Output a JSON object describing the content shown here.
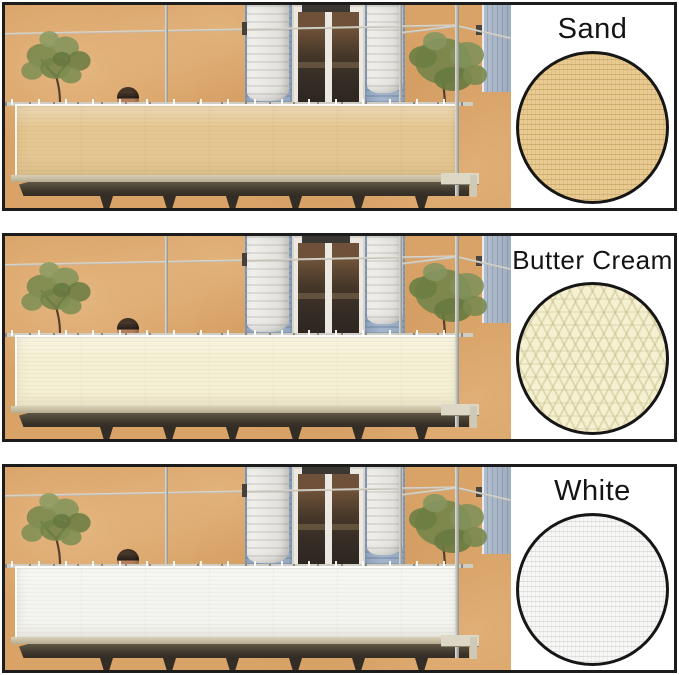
{
  "sheet": {
    "background": "#ffffff",
    "panel_border_color": "#1c1c1c",
    "text_color": "#141414"
  },
  "panels": [
    {
      "label": "Sand",
      "screen_color": "#e4c691",
      "swatch_color": "#e8cb90",
      "swatch_texture": "fine-rows-sand"
    },
    {
      "label": "Butter Cream",
      "screen_color": "#f5efd3",
      "swatch_color": "#f4f0d0",
      "swatch_texture": "coarse-knit"
    },
    {
      "label": "White",
      "screen_color": "#f4f4f0",
      "swatch_color": "#f7f7f5",
      "swatch_texture": "fine-rows-white"
    }
  ]
}
